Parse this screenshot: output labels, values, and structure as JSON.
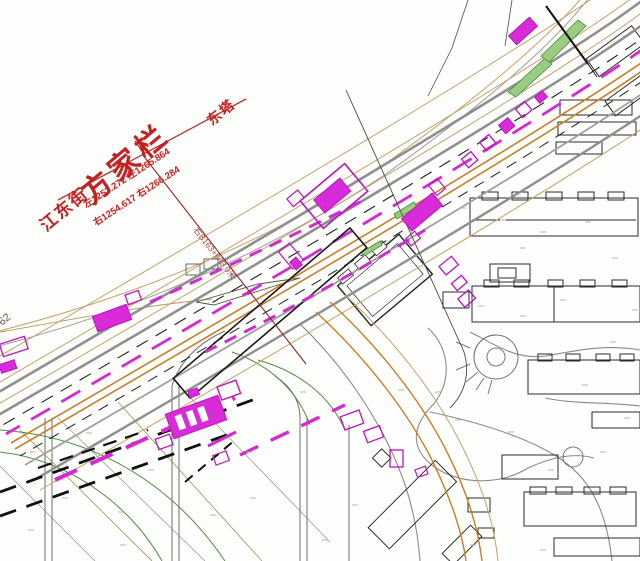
{
  "annotation": {
    "station_name": "方家栏",
    "street_name": "江东街",
    "chainage_row1": "左1253.272  左1265.864",
    "chainage_row2": "右1254.617  右1266.284",
    "tower_label": "东塔",
    "leader_label": "右B163+963.0米",
    "partial_road_label": "62"
  },
  "colors": {
    "annotation_red": "#c32222",
    "leader_dark_red": "#8b2a2a",
    "metro_magenta": "#d429d4",
    "alignment_orange": "#c77f2a",
    "sidewalk_tan": "#c2a26a",
    "road_gray": "#8f8f8f",
    "green_median": "#9ccb84",
    "building_black": "#2b2b2b"
  }
}
